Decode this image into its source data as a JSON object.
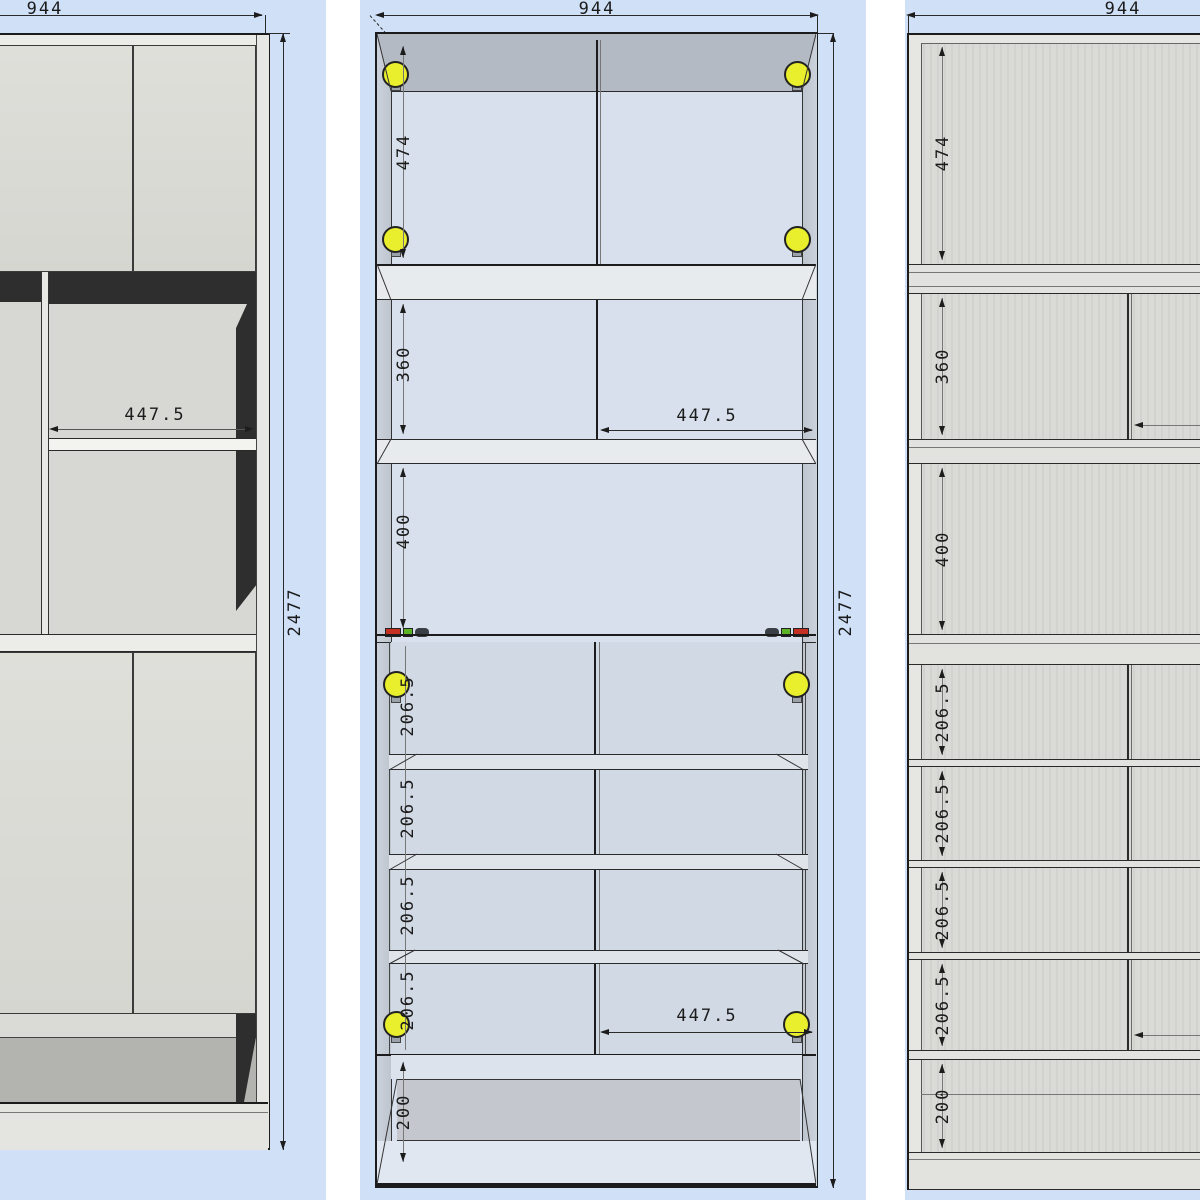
{
  "left_view": {
    "width_mm": "944",
    "height_mm": "2477",
    "shelf_width_mm": "447.5"
  },
  "middle_view": {
    "width_mm": "944",
    "height_mm": "2477",
    "top_section_mm": "474",
    "second_section_mm": "360",
    "third_section_mm": "400",
    "upper_shelf_width_mm": "447.5",
    "lower_shelf_width_mm": "447.5",
    "shoe_sections_mm": [
      "206.5",
      "206.5",
      "206.5",
      "206.5"
    ],
    "base_section_mm": "200"
  },
  "right_view": {
    "width_mm": "944",
    "top_section_mm": "474",
    "second_section_mm": "360",
    "third_section_mm": "400",
    "shoe_sections_mm": [
      "206.5",
      "206.5",
      "206.5",
      "206.5"
    ],
    "base_section_mm": "200"
  },
  "colors": {
    "background_blue": "#cfe0f7",
    "cabinet_gray": "#dbdbd6",
    "interior_blue": "#d7e0ec",
    "dark_shadow": "#2e2e2e",
    "hinge_yellow": "#e9ee2d",
    "connector_red": "#c53022",
    "connector_green": "#5cb424",
    "line_dark": "#1c1c1c"
  }
}
